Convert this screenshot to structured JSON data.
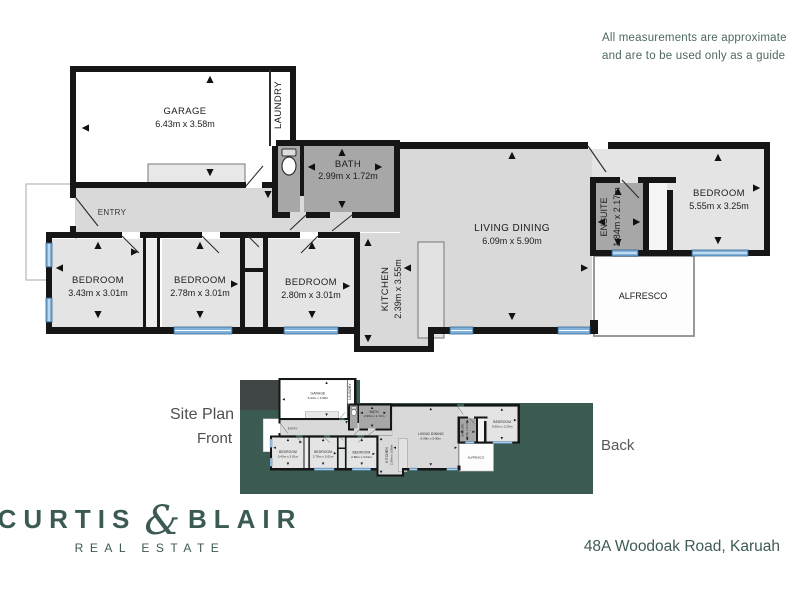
{
  "disclaimer": {
    "line1": "All measurements are approximate",
    "line2": "and are to be used only as a guide"
  },
  "plan": {
    "rooms": {
      "garage": {
        "name": "GARAGE",
        "dims": "6.43m x 3.58m"
      },
      "laundry": {
        "name": "LAUNDRY"
      },
      "bath": {
        "name": "BATH",
        "dims": "2.99m x 1.72m"
      },
      "entry": {
        "name": "ENTRY"
      },
      "living": {
        "name": "LIVING DINING",
        "dims": "6.09m x 5.90m"
      },
      "ensuite": {
        "name": "ENSUITE",
        "dims": "1.84m x 2.17m"
      },
      "bedroom_main": {
        "name": "BEDROOM",
        "dims": "5.55m x 3.25m"
      },
      "bedroom1": {
        "name": "BEDROOM",
        "dims": "3.43m x 3.01m"
      },
      "bedroom2": {
        "name": "BEDROOM",
        "dims": "2.78m x 3.01m"
      },
      "bedroom3": {
        "name": "BEDROOM",
        "dims": "2.80m x 3.01m"
      },
      "kitchen": {
        "name": "KITCHEN",
        "dims": "2.39m x 3.55m"
      },
      "alfresco": {
        "name": "ALFRESCO"
      }
    }
  },
  "site_plan": {
    "title": "Site Plan",
    "front_label": "Front",
    "back_label": "Back"
  },
  "brand": {
    "name_left": "CURTIS",
    "ampersand": "&",
    "name_right": "BLAIR",
    "tagline": "REAL ESTATE"
  },
  "address": "48A Woodoak Road, Karuah",
  "colors": {
    "brand_teal": "#3c5a54",
    "site_green": "#3a5a52",
    "driveway_gray": "#404646",
    "window_blue": "#7fb3dd",
    "wall_black": "#161616",
    "floor_light": "#d9d9d9",
    "floor_bedroom": "#e4e4e4",
    "floor_wet": "#a7a7a7"
  }
}
